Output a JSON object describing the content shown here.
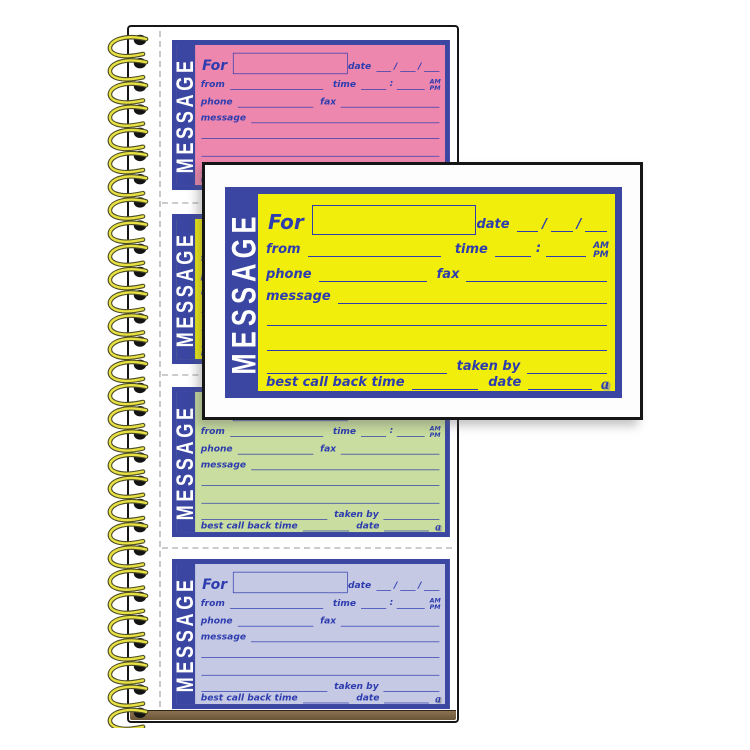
{
  "product": {
    "name": "wirebound phone message book",
    "accent_blue": "#3a46a2",
    "ink_blue": "#2d3cae",
    "wire_color": "#e8e144",
    "wire_edge_color": "#4c4c24",
    "chipboard_color": "#7b6243",
    "page_background": "#ffffff",
    "card_background": "#fdfdfd",
    "sheet_colors": [
      {
        "name": "pink",
        "hex": "#ee87ae"
      },
      {
        "name": "yellow",
        "hex": "#f2ee0c"
      },
      {
        "name": "green",
        "hex": "#c8dd9f"
      },
      {
        "name": "lavender",
        "hex": "#c6c9e4"
      }
    ],
    "detail_sheet_color": "#f2ee0c",
    "coil_count": 30
  },
  "form": {
    "sidebar_label": "MESSAGE",
    "for_label": "For",
    "date_label": "date",
    "date_separator": "/",
    "from_label": "from",
    "time_label": "time",
    "time_separator": ":",
    "am_label": "AM",
    "pm_label": "PM",
    "phone_label": "phone",
    "fax_label": "fax",
    "message_label": "message",
    "taken_by_label": "taken by",
    "best_call_back_label": "best call back time",
    "callback_date_label": "date",
    "brand_mark": "a"
  }
}
